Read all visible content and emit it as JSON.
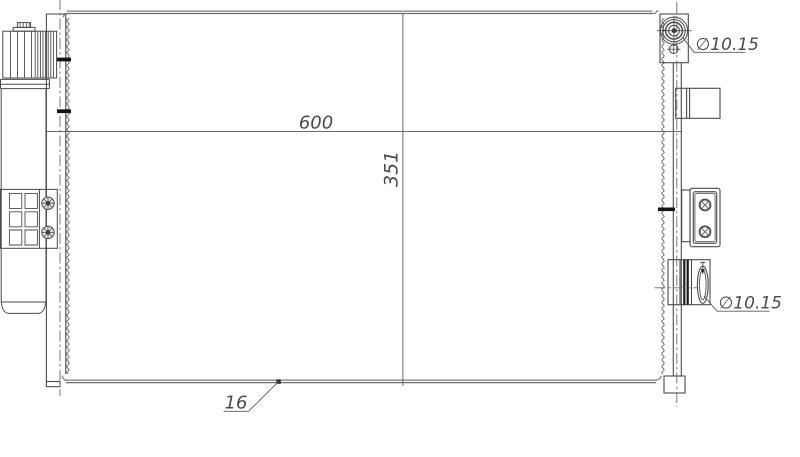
{
  "drawing": {
    "dimension_labels": {
      "core_width": "600",
      "core_height": "351",
      "core_depth": "16",
      "top_port_diameter": "∅10.15",
      "bottom_port_diameter": "∅10.15"
    },
    "colors": {
      "background": "#ffffff",
      "part_line": "#4a4a4a",
      "plate_gray": "#8f8f8f",
      "dim_line": "#5a5a5a",
      "baffle_black": "#151515"
    }
  }
}
